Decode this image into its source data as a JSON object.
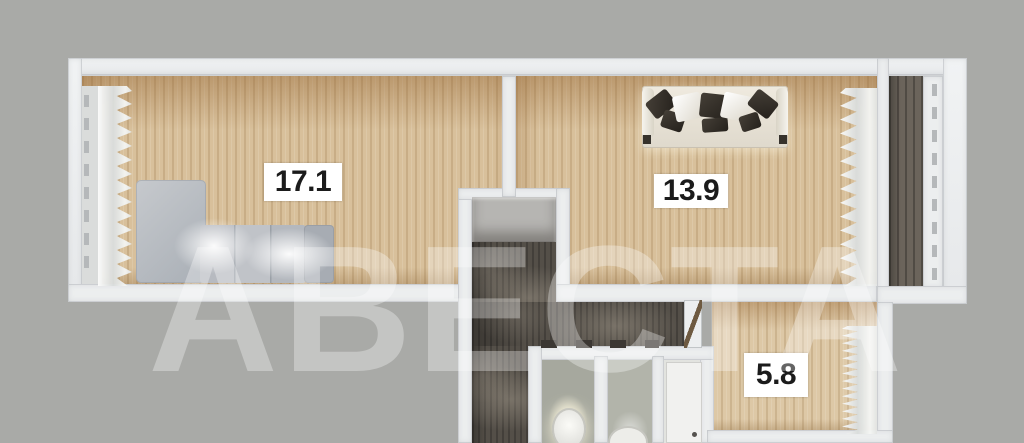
{
  "floorplan": {
    "watermark_text": "АВЕСТА",
    "rooms": [
      {
        "id": "living-room",
        "area_label": "17.1"
      },
      {
        "id": "bedroom",
        "area_label": "13.9"
      },
      {
        "id": "kitchen",
        "area_label": "5.8"
      }
    ],
    "colors": {
      "background": "#a9aaa7",
      "wall": "#eceeef",
      "wood_floor": "#d8c09b",
      "hallway_floor": "#544f48",
      "balcony_floor": "#6b645b",
      "label_background": "#ffffff",
      "label_text": "#1b1b1b",
      "watermark": "rgba(255,255,255,0.32)"
    }
  }
}
